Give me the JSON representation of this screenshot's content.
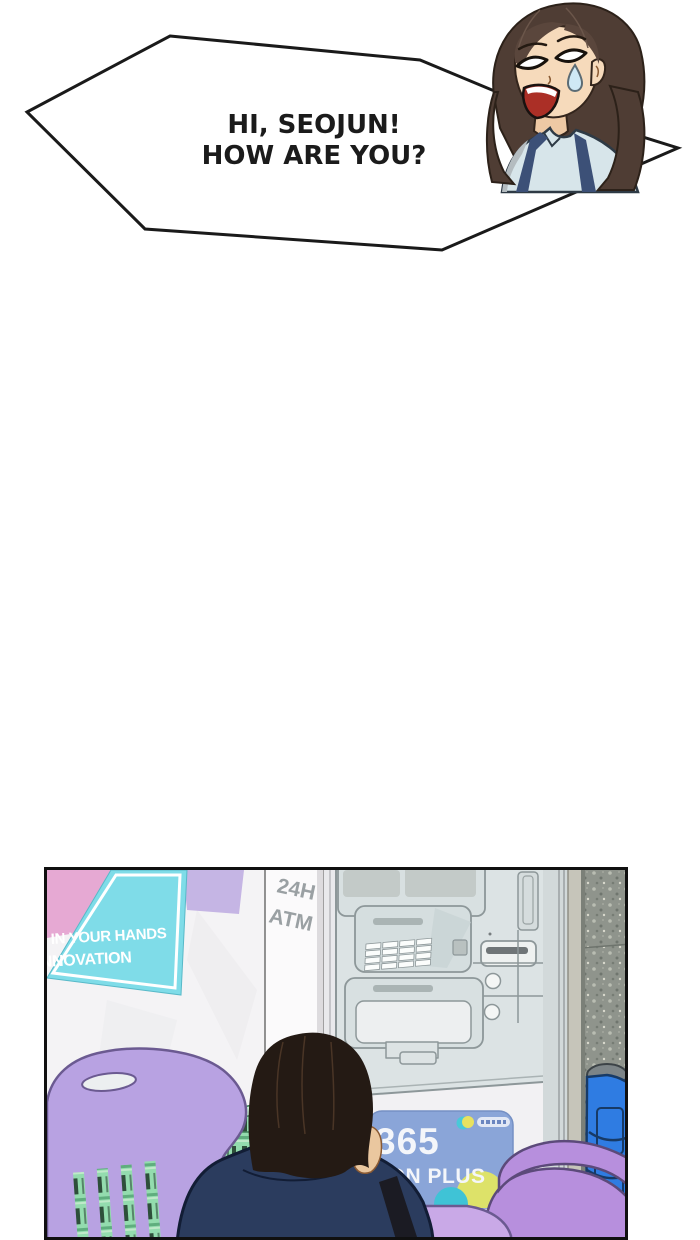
{
  "speech_bubble": {
    "line1": "HI, SEOJUN!",
    "line2": "HOW ARE YOU?"
  },
  "panel": {
    "poster": {
      "line1": "IN YOUR HANDS",
      "line2": "NNOVATION"
    },
    "atm_pillar": {
      "line1": "24H",
      "line2": "ATM"
    },
    "atm_card": {
      "number": "365",
      "label": "DON PLUS"
    }
  },
  "colors": {
    "bubble_outline": "#1a1a1a",
    "poster_teal": "#7fdce8",
    "poster_pink": "#e6a9d3",
    "poster_lavender": "#c5b5e4",
    "card_blue": "#8aa5d8",
    "chair_purple": "#b8a2e2",
    "crate_green": "#93dcae",
    "stool_blue": "#2f7ce2",
    "jacket_navy": "#2b3c5e",
    "granite_gray": "#8f948c",
    "atm_body": "#dce3e4"
  }
}
